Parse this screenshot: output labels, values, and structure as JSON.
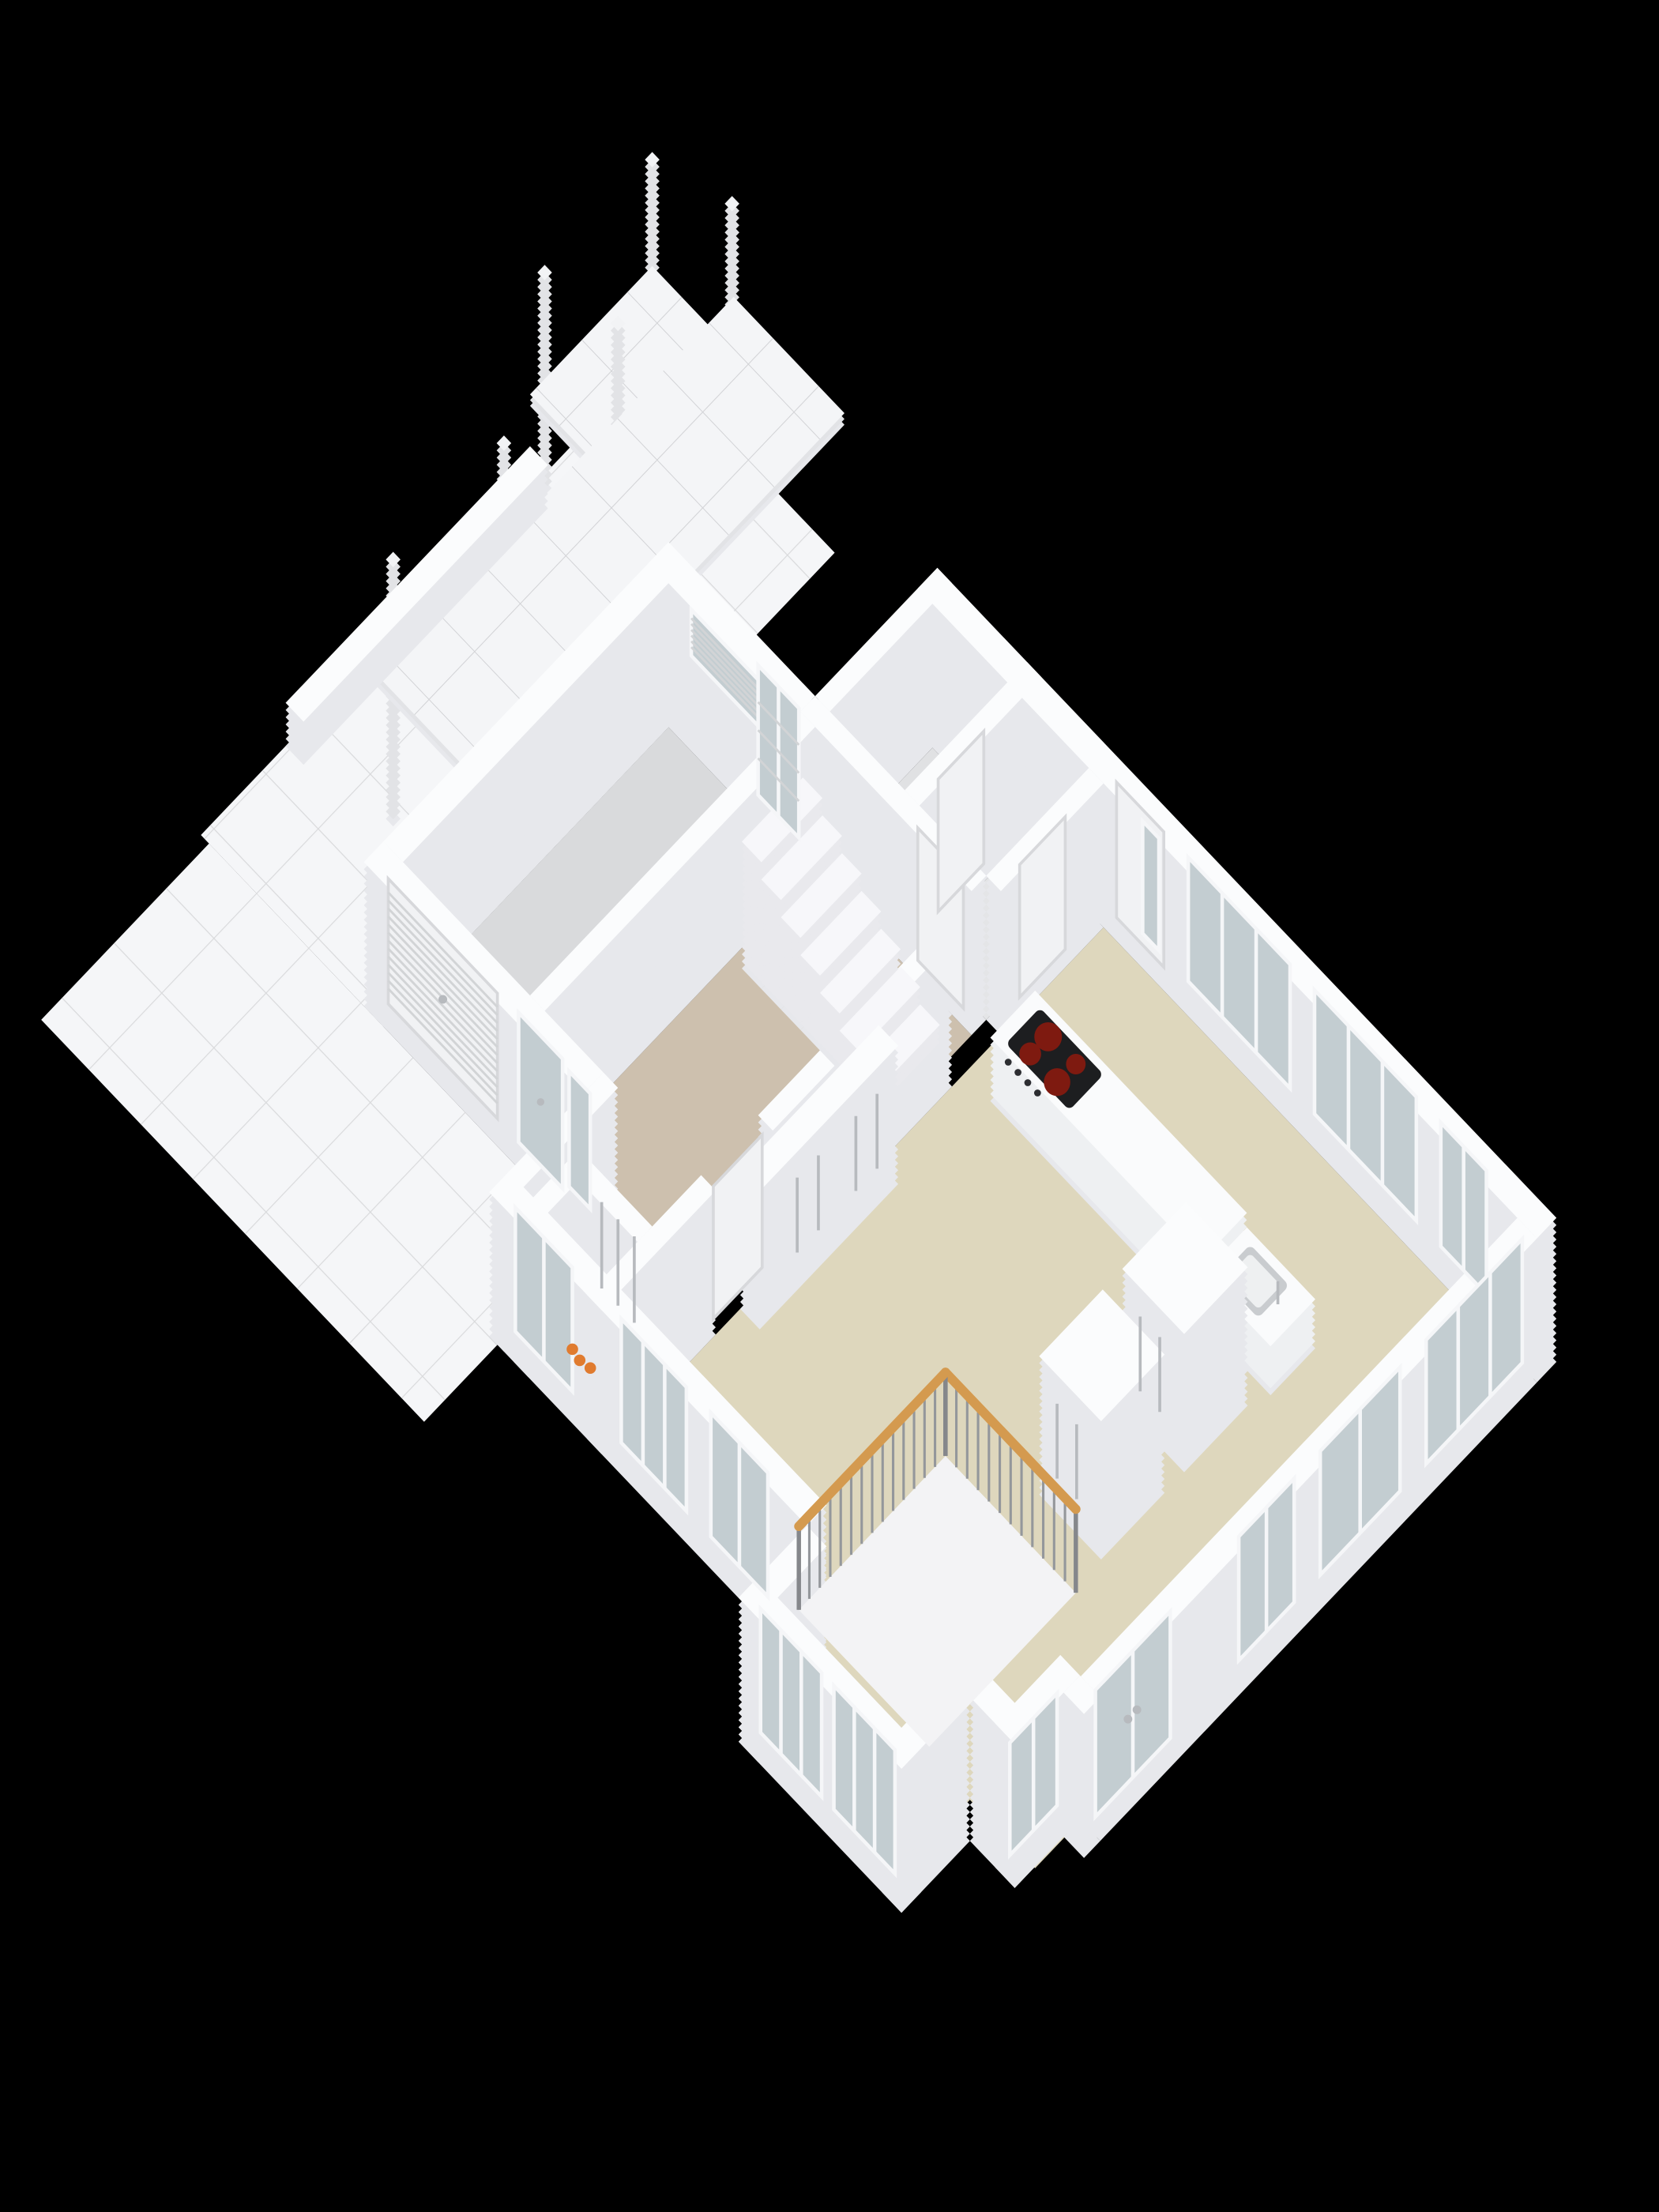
{
  "meta": {
    "title": "3D isometric floor plan - ground floor",
    "background": "#000000",
    "view": "isometric 3d floorplan render, no text labels"
  },
  "colors": {
    "bg": "#000000",
    "wall_top": "#fbfcfd",
    "wall_face": "#e7e8ec",
    "stair_face": "#e9e9ed",
    "stair_top": "#f7f7fa",
    "floor_living": "#ded7bd",
    "floor_hall": "#cdc0ae",
    "floor_entry": "#e4e5e7",
    "floor_wc": "#e0e1e3",
    "floor_garage": "#d9dadc",
    "floor_closet": "#cfc8ba",
    "tile_white": "#f5f6f8",
    "tile_line": "#d9dadc",
    "roof_top": "#f4f5f7",
    "roof_face": "#e2e3e6",
    "roof_line": "#d2d3d6",
    "post_face": "#e2e3e6",
    "post_top": "#f2f3f5",
    "glass": "#c3cdd1",
    "frame": "#f5f6f8",
    "door": "#f1f2f4",
    "door_edge": "#d7d8db",
    "slat": "#d2d4d6",
    "counter_top": "#fafbfc",
    "counter_face": "#eef0f2",
    "cooktop": "#1d1e20",
    "burner": "#e23420",
    "burner_dark": "#7e1a10",
    "knob": "#2c2d31",
    "sink": "#eef0f1",
    "sink_rim": "#c9cccf",
    "void": "#f3f3f5",
    "void_line": "#e0e0e4",
    "rail_wood": "#d49a4f",
    "baluster": "#94979b",
    "newel": "#85878b",
    "handle": "#b7babe",
    "orange_item": "#e07b2f",
    "dark_item": "#3a3a3e"
  },
  "scene": {
    "rooms": [
      {
        "id": "living-kitchen",
        "floor": "beige"
      },
      {
        "id": "hall",
        "floor": "warm tan, contains staircase"
      },
      {
        "id": "entry-vestibule",
        "floor": "light grey"
      },
      {
        "id": "wc",
        "floor": "light grey"
      },
      {
        "id": "garage",
        "floor": "grey, roller door to driveway"
      },
      {
        "id": "technical-closet",
        "floor": "tan, orange equipment inside"
      },
      {
        "id": "stairwell-void",
        "floor": "white opening with wood railing"
      },
      {
        "id": "carport",
        "floor": "white tiles, flat canopy roof on posts"
      },
      {
        "id": "driveway-terrace",
        "floor": "glossy white tiles"
      }
    ],
    "objects": [
      {
        "id": "kitchen-island",
        "detail": "white counter with black ceramic cooktop, 4 red burners, 4 knobs"
      },
      {
        "id": "sink-counter",
        "detail": "lower white counter with square sink and faucet"
      },
      {
        "id": "pantry-cabinets",
        "detail": "two tall white cabinet towers with long handles"
      },
      {
        "id": "wardrobe-closets",
        "detail": "built-in closet row with long vertical handles"
      },
      {
        "id": "staircase",
        "detail": "7 visible white steps ascending toward garage wall"
      },
      {
        "id": "stair-railing",
        "detail": "L-shaped wood handrail with thin grey balusters"
      },
      {
        "id": "garage-roller-door",
        "detail": "white horizontal slats with handle"
      },
      {
        "id": "garage-vent-window",
        "detail": "long slatted band window high in garage wall"
      },
      {
        "id": "front-door",
        "detail": "white door with tall glass pane on NE facade"
      },
      {
        "id": "side-entrance-door",
        "detail": "glazed door plus sidelight beside roller door"
      },
      {
        "id": "french-doors",
        "detail": "double glazed doors with handles on SE facade"
      },
      {
        "id": "canopy-posts",
        "count": 6,
        "detail": "thin square white posts supporting flat canopy"
      },
      {
        "id": "parapet-wall",
        "detail": "low white wall at west terrace edge"
      }
    ],
    "window_groups": {
      "northeast_wall": 3,
      "east_wall": 3,
      "french_doors_east": 1,
      "jog_window_east": 1,
      "south_bay": 2,
      "south_wall": 2,
      "hall_south": 1,
      "garage_vent": 1
    }
  }
}
